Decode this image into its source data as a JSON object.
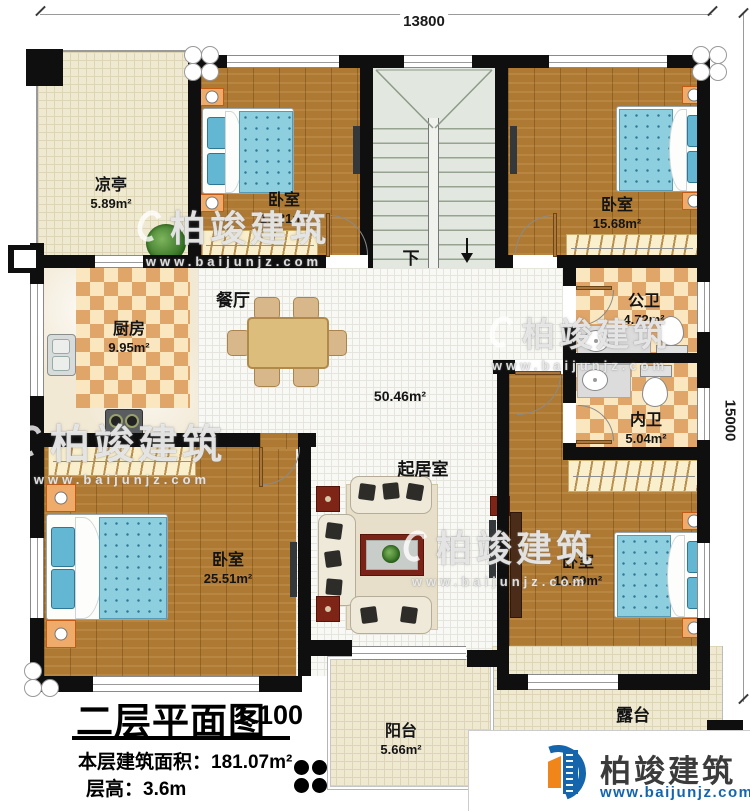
{
  "plan": {
    "dimensions": {
      "top": "13800",
      "right": "15000"
    },
    "stairs": {
      "down_label": "下"
    },
    "rooms": {
      "gazebo": {
        "name": "凉亭",
        "area": "5.89m²"
      },
      "bedroom_top_left": {
        "name": "卧室",
        "area": "13.31m²"
      },
      "bedroom_top_right": {
        "name": "卧室",
        "area": "15.68m²"
      },
      "kitchen": {
        "name": "厨房",
        "area": "9.95m²"
      },
      "dining": {
        "name": "餐厅"
      },
      "public_bathroom": {
        "name": "公卫",
        "area": "4.72m²"
      },
      "private_bathroom": {
        "name": "内卫",
        "area": "5.04m²"
      },
      "living": {
        "name": "起居室",
        "area": "50.46m²"
      },
      "bedroom_bottom_left": {
        "name": "卧室",
        "area": "25.51m²"
      },
      "bedroom_bottom_right": {
        "name": "卧室",
        "area": "19.59m²"
      },
      "balcony": {
        "name": "阳台",
        "area": "5.66m²"
      },
      "terrace": {
        "name": "露台"
      }
    }
  },
  "title_block": {
    "title": "二层平面图",
    "scale": "1:100",
    "area_line": "本层建筑面积：181.07m²",
    "height_line": "层高：3.6m"
  },
  "branding": {
    "name": "柏竣建筑",
    "website": "www.baijunjz.com"
  },
  "watermark": {
    "brand": "柏竣建筑",
    "url": "www.baijunjz.com"
  },
  "colors": {
    "wall": "#0f0f0f",
    "wood_floor": "#ae7933",
    "tile_cream": "#efe9d2",
    "checker_tan": "#dfa569",
    "checker_cream": "#fbe7bf",
    "bed_blue": "#8ecfdf",
    "logo_blue": "#1565ad",
    "logo_orange": "#f08519"
  }
}
